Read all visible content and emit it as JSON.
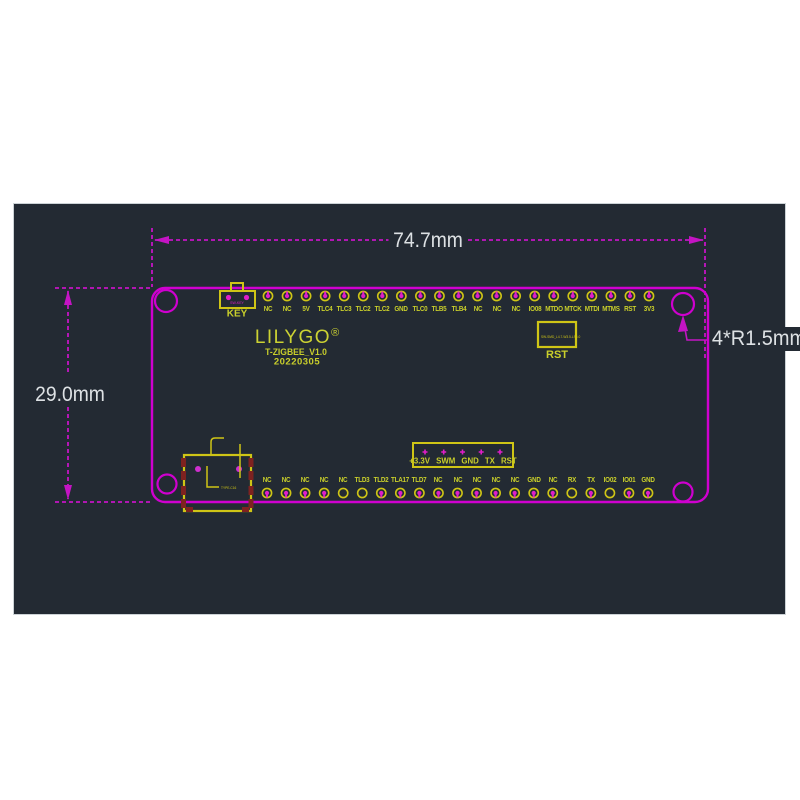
{
  "dimensions": {
    "width_label": "74.7mm",
    "height_label": "29.0mm",
    "corner_radius_label": "4*R1.5mm"
  },
  "silkscreen": {
    "logo": "LILYGO",
    "logo_reg": "®",
    "model": "T-ZIGBEE_V1.0",
    "date": "20220305"
  },
  "buttons": {
    "key": {
      "label": "KEY",
      "part_text": "SW-KEY"
    },
    "rst": {
      "label": "RST",
      "part_text": "SW-SMD_L4.7-W3.5-LS6.0"
    }
  },
  "usb": {
    "part_text": "TYPE-C16"
  },
  "connector5": {
    "text": "+3.3V SWM GND TX RST"
  },
  "colors": {
    "board_outline": "#cf00cf",
    "dimension_line": "#c414c4",
    "silk_yellow": "#cfc516",
    "label_yellow": "#c9cf2b",
    "pad_magenta": "#e01ec8",
    "usb_pad_red": "#7e2220",
    "background_dark": "#232a33",
    "dim_text": "#dde1e4"
  },
  "pins": {
    "top": [
      {
        "label": "NC",
        "filled": true
      },
      {
        "label": "NC",
        "filled": true
      },
      {
        "label": "5V",
        "filled": true
      },
      {
        "label": "TLC4",
        "filled": true
      },
      {
        "label": "TLC3",
        "filled": true
      },
      {
        "label": "TLC2",
        "filled": true
      },
      {
        "label": "TLC2",
        "filled": true
      },
      {
        "label": "GND",
        "filled": true
      },
      {
        "label": "TLC0",
        "filled": true
      },
      {
        "label": "TLB5",
        "filled": true
      },
      {
        "label": "TLB4",
        "filled": true
      },
      {
        "label": "NC",
        "filled": true
      },
      {
        "label": "NC",
        "filled": true
      },
      {
        "label": "NC",
        "filled": true
      },
      {
        "label": "IO08",
        "filled": true
      },
      {
        "label": "MTDO",
        "filled": true
      },
      {
        "label": "MTCK",
        "filled": true
      },
      {
        "label": "MTDI",
        "filled": true
      },
      {
        "label": "MTMS",
        "filled": true
      },
      {
        "label": "RST",
        "filled": true
      },
      {
        "label": "3V3",
        "filled": true
      }
    ],
    "bottom": [
      {
        "label": "NC",
        "filled": true
      },
      {
        "label": "NC",
        "filled": true
      },
      {
        "label": "NC",
        "filled": true
      },
      {
        "label": "NC",
        "filled": true
      },
      {
        "label": "NC",
        "filled": false
      },
      {
        "label": "TLD3",
        "filled": false
      },
      {
        "label": "TLD2",
        "filled": true
      },
      {
        "label": "TLA17",
        "filled": true
      },
      {
        "label": "TLD7",
        "filled": true
      },
      {
        "label": "NC",
        "filled": true
      },
      {
        "label": "NC",
        "filled": true
      },
      {
        "label": "NC",
        "filled": true
      },
      {
        "label": "NC",
        "filled": true
      },
      {
        "label": "NC",
        "filled": true
      },
      {
        "label": "GND",
        "filled": true
      },
      {
        "label": "NC",
        "filled": true
      },
      {
        "label": "RX",
        "filled": false
      },
      {
        "label": "TX",
        "filled": true
      },
      {
        "label": "IO02",
        "filled": false
      },
      {
        "label": "IO01",
        "filled": true
      },
      {
        "label": "GND",
        "filled": true
      }
    ]
  }
}
